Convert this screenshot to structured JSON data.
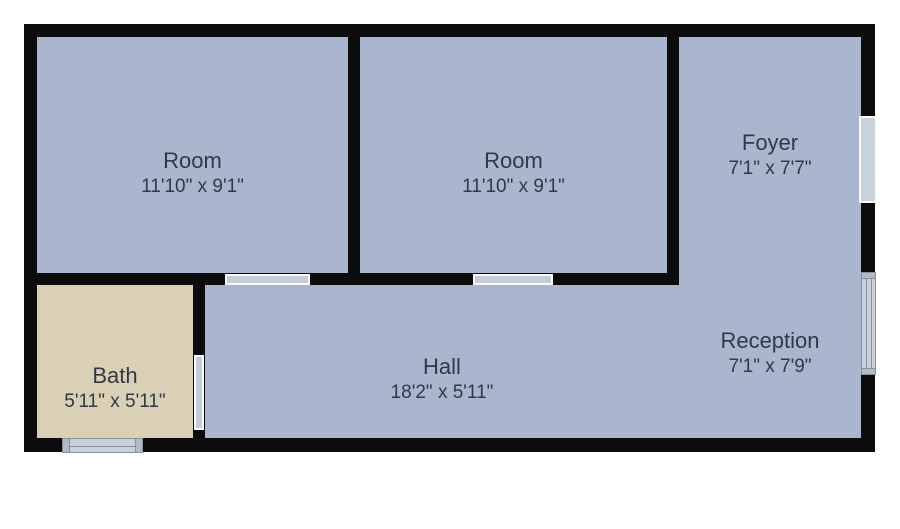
{
  "plan": {
    "rooms": [
      {
        "name": "Room",
        "dims": "11'10\" x 9'1\""
      },
      {
        "name": "Room",
        "dims": "11'10\" x 9'1\""
      },
      {
        "name": "Foyer",
        "dims": "7'1\" x 7'7\""
      },
      {
        "name": "Reception",
        "dims": "7'1\" x 7'9\""
      },
      {
        "name": "Bath",
        "dims": "5'11\" x 5'11\""
      },
      {
        "name": "Hall",
        "dims": "18'2\" x 5'11\""
      }
    ],
    "features": [
      "door-opening-room1-to-hall",
      "door-opening-room2-to-hall",
      "door-opening-bath-to-hall",
      "window-foyer-right-wall",
      "window-reception-right-wall",
      "window-bath-bottom-wall"
    ],
    "colors": {
      "wall": "#0c0c0c",
      "room_fill": "#aab6ce",
      "bath_fill": "#dad0b5",
      "opening_fill": "#c4cedb",
      "window_fill": "#c9d1dd",
      "window_frame": "#8a919d",
      "window_cap": "#b3bac5",
      "text": "#2f3947",
      "background": "#ffffff"
    }
  }
}
